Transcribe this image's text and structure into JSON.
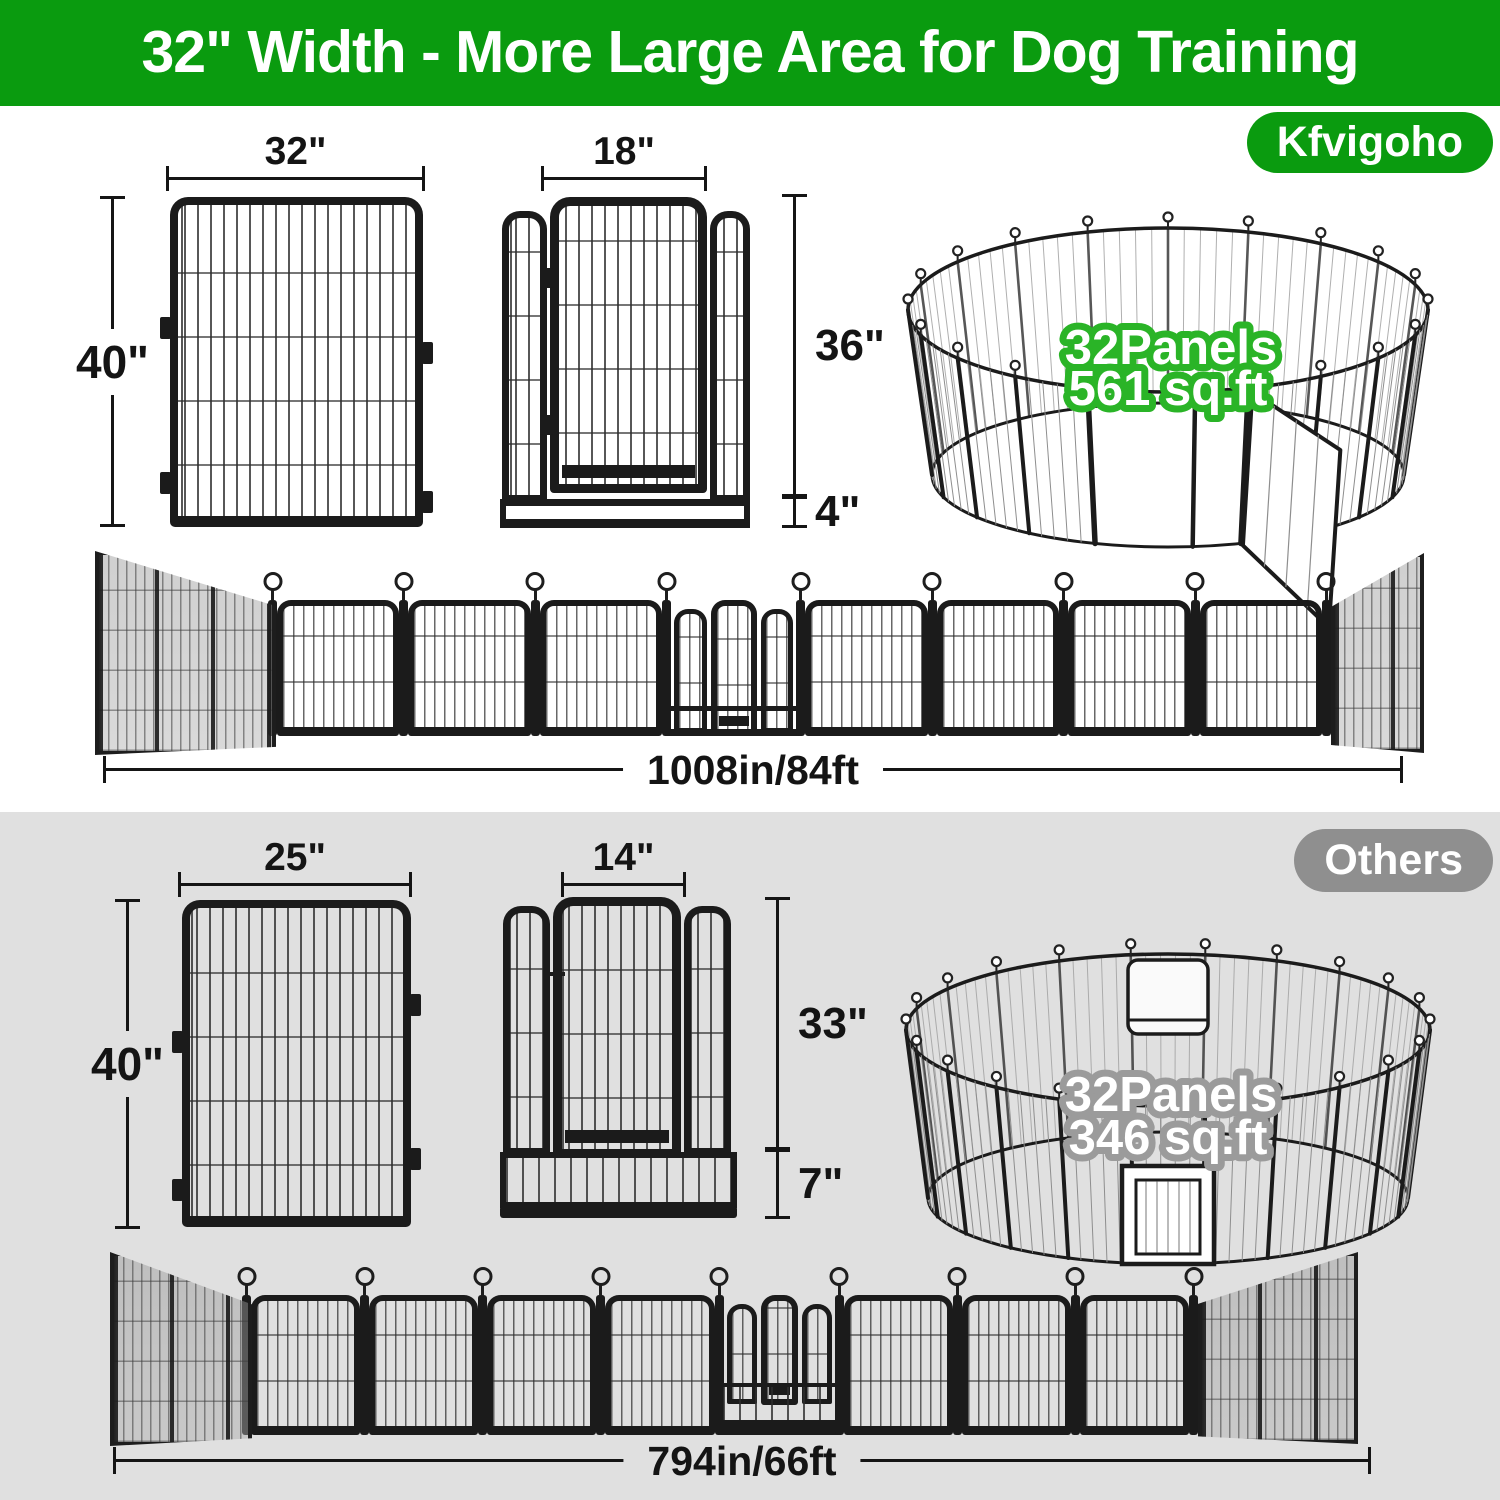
{
  "banner": {
    "title": "32\" Width - More Large Area for Dog Training"
  },
  "brand": {
    "label": "Kfvigoho"
  },
  "sections": {
    "kfvigoho": {
      "panel": {
        "width": "32\"",
        "height": "40\""
      },
      "door": {
        "width": "18\"",
        "height": "36\"",
        "base": "4\""
      },
      "ring": {
        "line1": "32Panels",
        "line2": "561 sq.ft"
      },
      "row": {
        "length": "1008in/84ft"
      }
    },
    "others": {
      "badge": "Others",
      "panel": {
        "width": "25\"",
        "height": "40\""
      },
      "door": {
        "width": "14\"",
        "height": "33\"",
        "base": "7\""
      },
      "ring": {
        "line1": "32Panels",
        "line2": "346 sq.ft"
      },
      "row": {
        "length": "794in/66ft"
      }
    }
  },
  "colors": {
    "banner_green": "#0a9b0f",
    "ring_outline_green": "#2ab427",
    "ring_outline_gray": "#9b9b9b",
    "badge_gray": "#8f8f8f",
    "section_gray": "#e0e0e0",
    "fence_ink": "#1b1b1b"
  }
}
